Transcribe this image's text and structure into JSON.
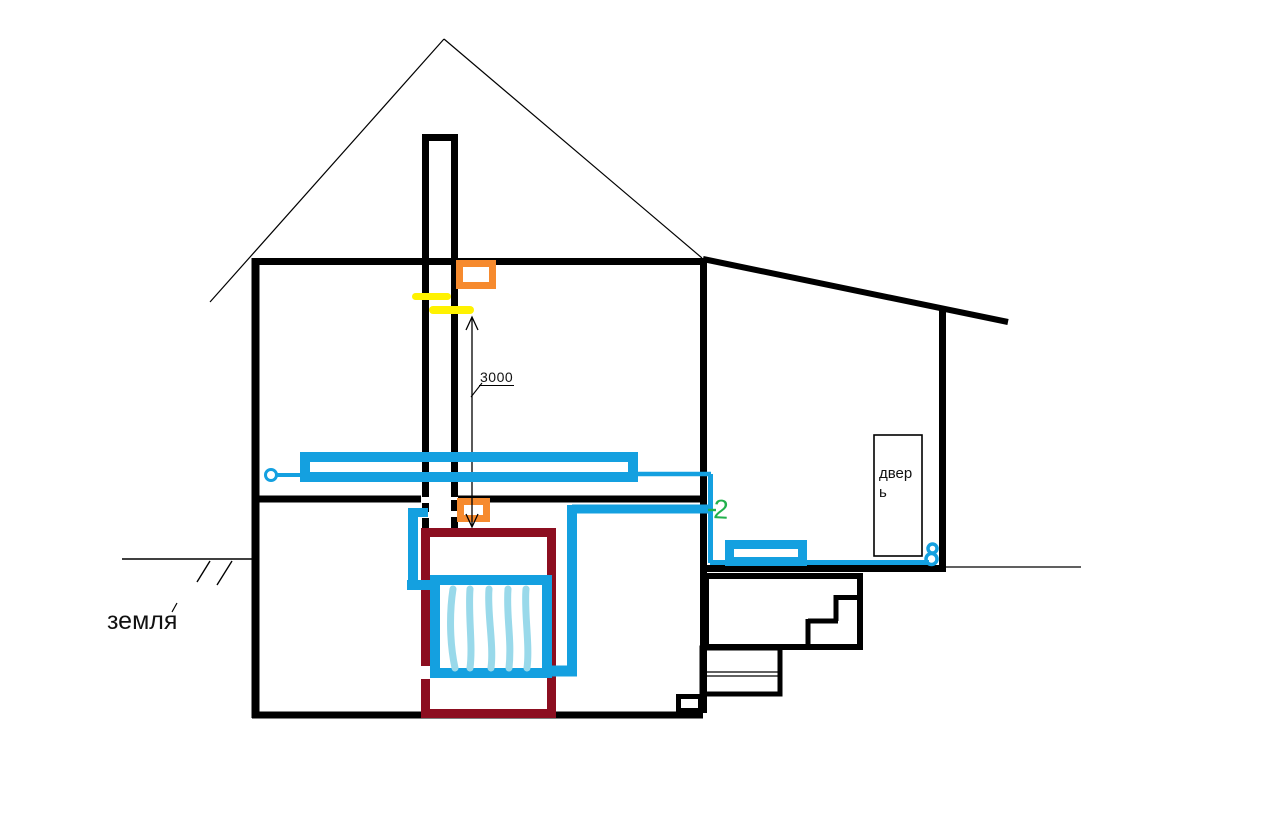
{
  "drawing_title": "house heating system sketch",
  "labels": {
    "ground": "земля",
    "ground_tick": "´",
    "door_line1": "двер",
    "door_line2": "ь",
    "dimension_value": "3000",
    "junction_number": "2"
  },
  "colors": {
    "pipe_blue": "#14A0E0",
    "fin_light_blue": "#99D9EA",
    "furnace_maroon": "#8C0E20",
    "orange": "#F68A2E",
    "yellow": "#FFF200",
    "green": "#22B14C",
    "line_black": "#000000"
  }
}
